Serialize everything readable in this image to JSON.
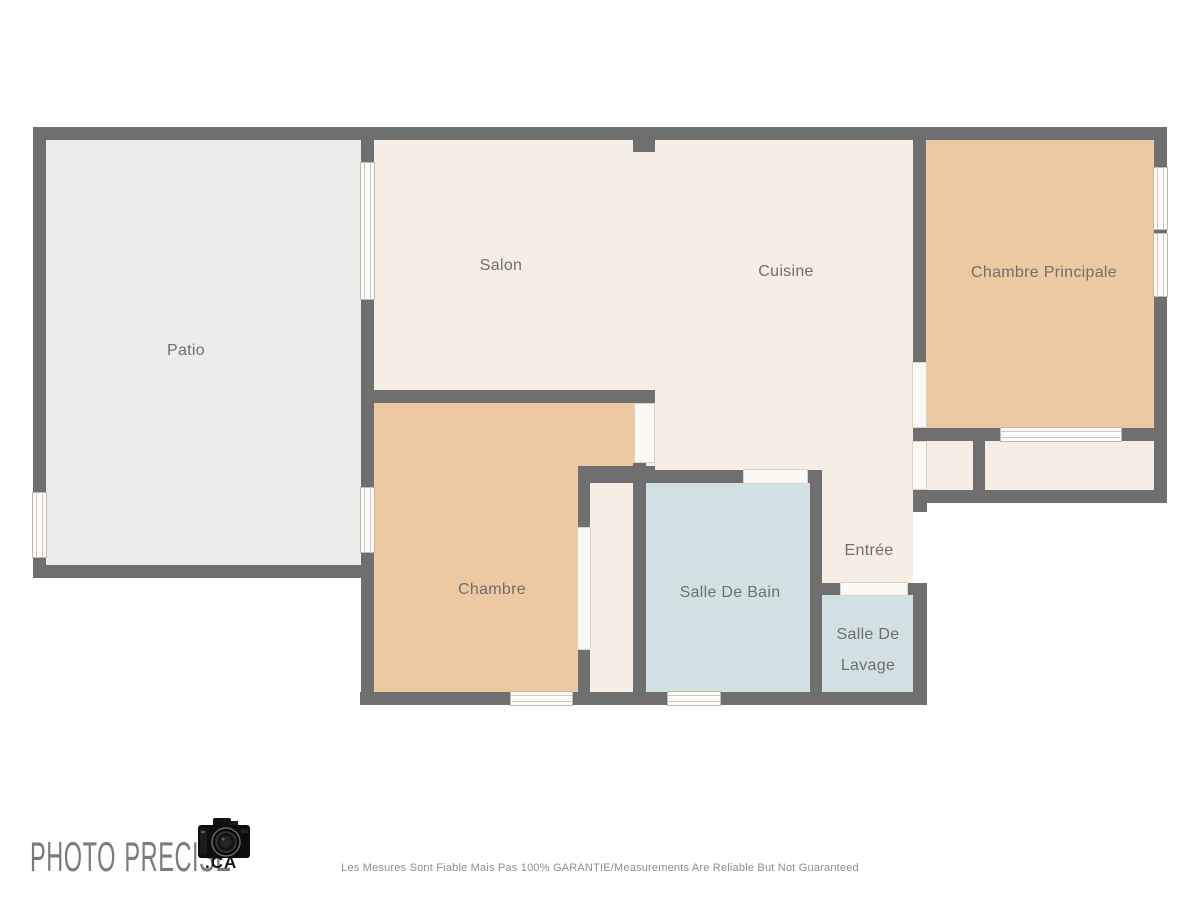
{
  "rooms": {
    "patio": "Patio",
    "salon": "Salon",
    "cuisine": "Cuisine",
    "chambre_principale": "Chambre Principale",
    "chambre": "Chambre",
    "salle_de_bain": "Salle De Bain",
    "entree": "Entrée",
    "salle_de_lavage": {
      "line1": "Salle De",
      "line2": "Lavage"
    }
  },
  "branding": {
    "word1": "PHOTO",
    "word2": "PRECISE",
    "suffix": ".CA",
    "camera_icon": "dslr-camera"
  },
  "footer": {
    "disclaimer": "Les Mesures Sont Fiable Mais Pas 100% GARANTIE/Measurements Are Reliable But Not Guaranteed"
  },
  "colors": {
    "wall": "#6f6f6f",
    "floor_patio": "#ececec",
    "floor_living": "#f6ede5",
    "floor_bedroom": "#edc9a2",
    "floor_wet": "#d1e1e3",
    "window_fill": "#fdfbf7",
    "label_text": "#6f6f6f"
  }
}
